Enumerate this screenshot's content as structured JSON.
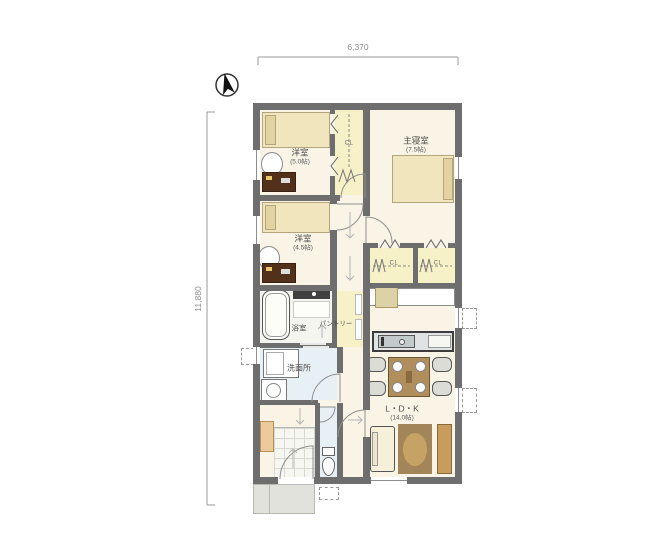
{
  "dimensions": {
    "top": "6,370",
    "left": "11,880"
  },
  "rooms": {
    "bedroom1": {
      "name": "洋室",
      "size": "(5.0帖)"
    },
    "bedroom2": {
      "name": "洋室",
      "size": "(4.5帖)"
    },
    "master_bedroom": {
      "name": "主寝室",
      "size": "(7.5帖)"
    },
    "bathroom": {
      "name": "浴室"
    },
    "pantry": {
      "name": "パントリー"
    },
    "washroom": {
      "name": "洗面所"
    },
    "ldk": {
      "name": "L・D・K",
      "size": "(14.0帖)"
    }
  },
  "closets": {
    "top": "CL",
    "left": "CL",
    "right": "CL"
  },
  "colors": {
    "wall": "#6e6e6e",
    "floor": "#faf4e6",
    "closet": "#f7f1c8",
    "wet_area": "#e7f0f4",
    "bed": "#f1e5bd",
    "wood": "#b08f5d",
    "rug": "#a28559",
    "desk": "#533019"
  }
}
